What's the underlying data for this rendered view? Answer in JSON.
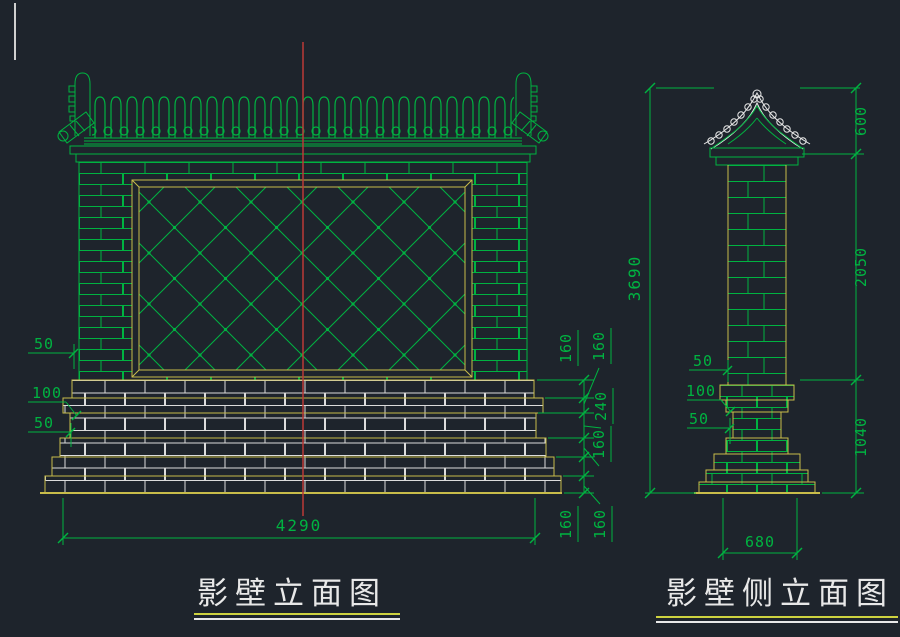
{
  "app": {
    "background_color": "#1e242c",
    "colors": {
      "drawing_green": "#00b341",
      "drawing_yellow": "#c8bc4a",
      "drawing_white": "#e8e8e8",
      "centerline_red": "#bb3a37",
      "title_underline_yellow": "#cdd23f"
    }
  },
  "front_elevation": {
    "title": "影壁立面图",
    "dims": {
      "total_width": "4290",
      "left_offsets": [
        "50",
        "100",
        "50"
      ],
      "height_chain": [
        "160",
        "160",
        "240",
        "160",
        "160",
        "160"
      ]
    }
  },
  "side_elevation": {
    "title": "影壁侧立面图",
    "dims": {
      "total_height": "3690",
      "roof_height": "600",
      "shaft_height": "2050",
      "base_height": "1040",
      "base_width": "680",
      "left_offsets": [
        "50",
        "100",
        "50"
      ]
    }
  }
}
